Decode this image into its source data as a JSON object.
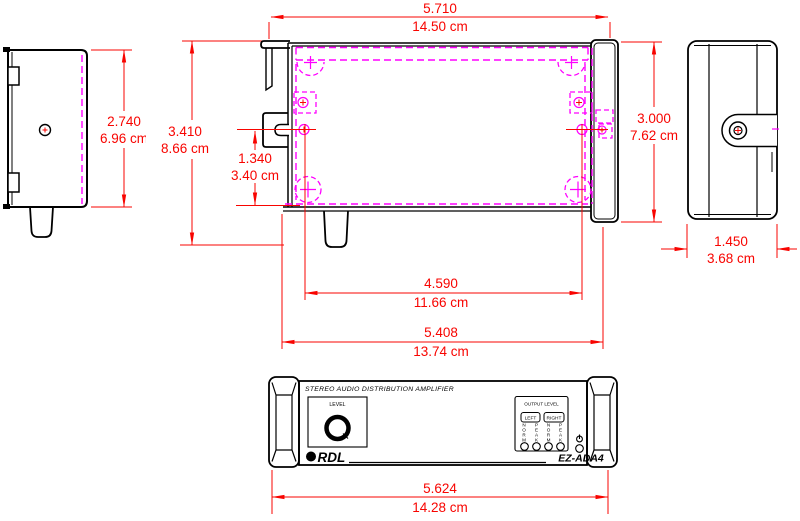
{
  "colors": {
    "dimension_red": "#f80400",
    "hidden_magenta": "#ff00ff",
    "outline_black": "#000000"
  },
  "dimensions": {
    "top_width": {
      "inches": "5.710",
      "cm": "14.50 cm"
    },
    "left_body_height": {
      "inches": "2.740",
      "cm": "6.96 cm"
    },
    "overall_height": {
      "inches": "3.410",
      "cm": "8.66 cm"
    },
    "slot_to_base": {
      "inches": "1.340",
      "cm": "3.40 cm"
    },
    "end_panel_height": {
      "inches": "3.000",
      "cm": "7.62 cm"
    },
    "depth": {
      "inches": "1.450",
      "cm": "3.68 cm"
    },
    "mounting_hole_spacing": {
      "inches": "4.590",
      "cm": "11.66 cm"
    },
    "chassis_width": {
      "inches": "5.408",
      "cm": "13.74 cm"
    },
    "front_panel_width": {
      "inches": "5.624",
      "cm": "14.28 cm"
    }
  },
  "front_panel": {
    "heading": "STEREO AUDIO DISTRIBUTION AMPLIFIER",
    "level_label": "LEVEL",
    "output_level_label": "OUTPUT LEVEL",
    "left_button_label": "LEFT",
    "right_button_label": "RIGHT",
    "meter_labels": [
      "NORM",
      "PEAK",
      "NORM",
      "PEAK"
    ],
    "brand": "RDL",
    "model": "EZ-ADA4"
  },
  "icons": {
    "power": "standby-power-symbol"
  }
}
